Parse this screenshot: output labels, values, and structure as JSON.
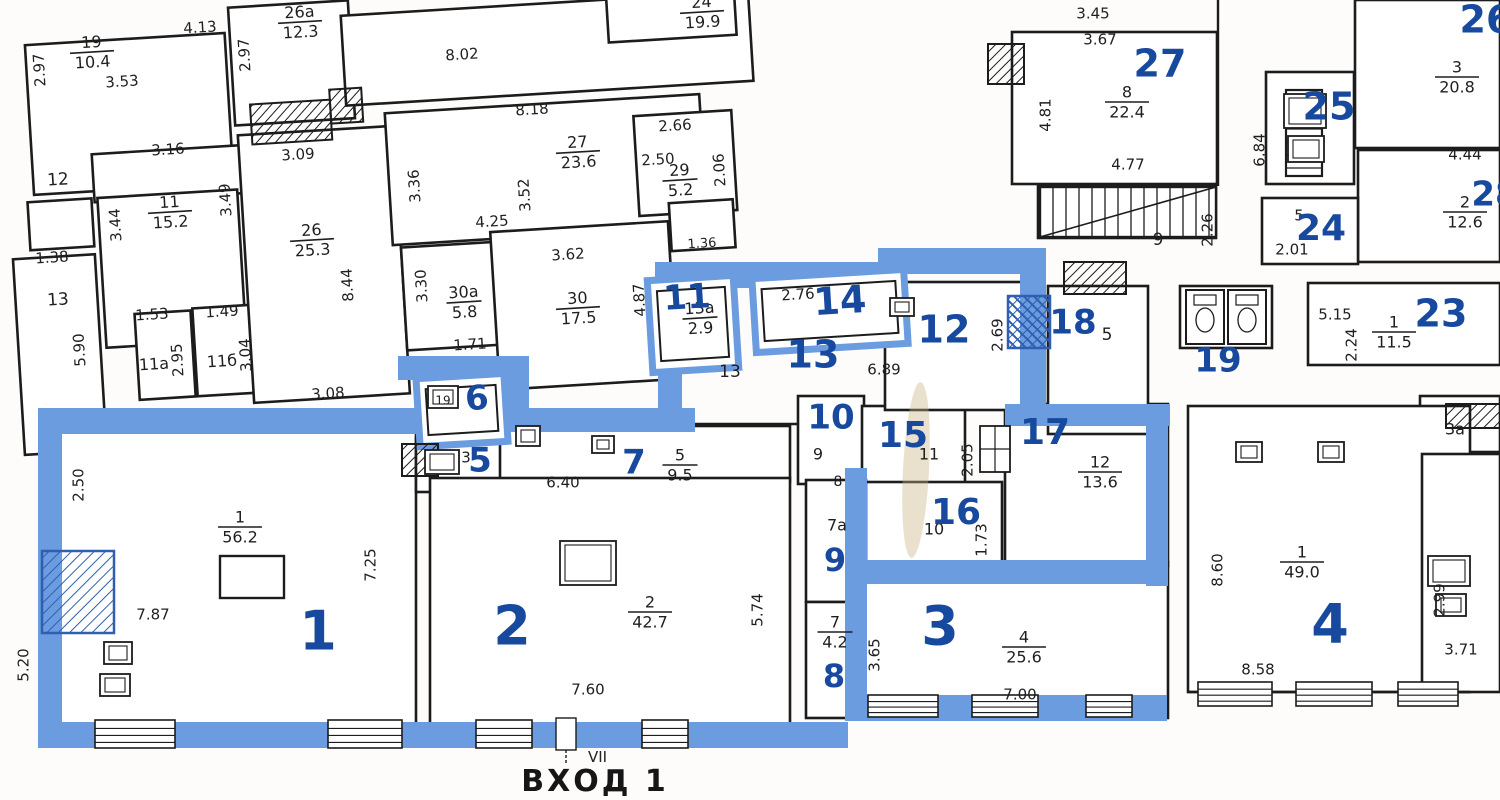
{
  "colors": {
    "highlight_band": "#6b9ce0",
    "highlight_band_dark": "#2e5fb0",
    "room_number_blue": "#17499e",
    "wall_black": "#1c1c1c",
    "paper": "#fdfcfa",
    "stain": "#c9b184"
  },
  "entrance": {
    "label": "ВХОД 1",
    "vestibule_mark": "VII"
  },
  "unit_room_numbers": [
    [
      "1",
      318,
      635,
      54,
      ""
    ],
    [
      "2",
      512,
      630,
      54,
      ""
    ],
    [
      "3",
      940,
      630,
      54,
      ""
    ],
    [
      "4",
      1330,
      628,
      54,
      ""
    ],
    [
      "5",
      480,
      462,
      34,
      ""
    ],
    [
      "6",
      477,
      400,
      34,
      "t"
    ],
    [
      "7",
      634,
      464,
      34,
      ""
    ],
    [
      "8",
      834,
      678,
      32,
      ""
    ],
    [
      "9",
      835,
      562,
      32,
      ""
    ],
    [
      "10",
      831,
      419,
      34,
      ""
    ],
    [
      "11",
      687,
      299,
      34,
      "t"
    ],
    [
      "12",
      944,
      332,
      38,
      ""
    ],
    [
      "13",
      813,
      357,
      38,
      ""
    ],
    [
      "14",
      840,
      303,
      38,
      "t"
    ],
    [
      "15",
      903,
      437,
      36,
      ""
    ],
    [
      "16",
      956,
      514,
      36,
      ""
    ],
    [
      "17",
      1045,
      434,
      36,
      ""
    ],
    [
      "18",
      1073,
      324,
      34,
      ""
    ],
    [
      "19",
      1218,
      362,
      34,
      ""
    ]
  ],
  "neighbor_room_numbers": [
    [
      "23",
      1441,
      316,
      38,
      ""
    ],
    [
      "24",
      1321,
      230,
      36,
      ""
    ],
    [
      "25",
      1329,
      109,
      38,
      ""
    ],
    [
      "26",
      1486,
      22,
      38,
      ""
    ],
    [
      "27",
      1160,
      66,
      38,
      ""
    ],
    [
      "28",
      1495,
      196,
      34,
      ""
    ]
  ],
  "room_area_labels": [
    [
      "19",
      "10.4",
      92,
      52,
      "t"
    ],
    [
      "26а",
      "12.3",
      300,
      22,
      "t"
    ],
    [
      "11",
      "15.2",
      170,
      212,
      "t"
    ],
    [
      "26",
      "25.3",
      312,
      240,
      "t"
    ],
    [
      "27",
      "23.6",
      578,
      152,
      "t"
    ],
    [
      "24",
      "19.9",
      702,
      12,
      "t"
    ],
    [
      "29",
      "5.2",
      680,
      180,
      "t"
    ],
    [
      "30а",
      "5.8",
      464,
      302,
      "t"
    ],
    [
      "30",
      "17.5",
      578,
      308,
      "t"
    ],
    [
      "13а",
      "2.9",
      700,
      318,
      "t"
    ],
    [
      "8",
      "22.4",
      1127,
      102,
      ""
    ],
    [
      "3",
      "20.8",
      1457,
      77,
      ""
    ],
    [
      "2",
      "12.6",
      1465,
      212,
      ""
    ],
    [
      "1",
      "11.5",
      1394,
      332,
      ""
    ],
    [
      "5",
      "9.5",
      680,
      465,
      ""
    ],
    [
      "12",
      "13.6",
      1100,
      472,
      ""
    ],
    [
      "4",
      "25.6",
      1024,
      647,
      ""
    ],
    [
      "2",
      "42.7",
      650,
      612,
      ""
    ],
    [
      "1",
      "56.2",
      240,
      527,
      ""
    ],
    [
      "1",
      "49.0",
      1302,
      562,
      ""
    ],
    [
      "7",
      "4.2",
      835,
      632,
      ""
    ]
  ],
  "dimension_labels": [
    [
      "2.97",
      40,
      70,
      "vt"
    ],
    [
      "3.53",
      122,
      82,
      "t"
    ],
    [
      "4.13",
      200,
      28,
      "t"
    ],
    [
      "2.97",
      245,
      55,
      "vt"
    ],
    [
      "3.16",
      168,
      150,
      "t"
    ],
    [
      "3.09",
      298,
      155,
      "t"
    ],
    [
      "12",
      58,
      180,
      "t",
      17
    ],
    [
      "3.44",
      116,
      225,
      "vt"
    ],
    [
      "3.49",
      226,
      200,
      "vt"
    ],
    [
      "1.38",
      52,
      258,
      "t"
    ],
    [
      "13",
      58,
      300,
      "t",
      17
    ],
    [
      "8.44",
      348,
      285,
      "vt"
    ],
    [
      "1.53",
      152,
      315,
      "t"
    ],
    [
      "1.49",
      222,
      312,
      "t"
    ],
    [
      "5.90",
      80,
      350,
      "vt"
    ],
    [
      "11а",
      154,
      365,
      "t",
      16
    ],
    [
      "2.95",
      178,
      360,
      "vt"
    ],
    [
      "11б",
      222,
      362,
      "t",
      16
    ],
    [
      "3.04",
      246,
      355,
      "vt"
    ],
    [
      "3.08",
      328,
      394,
      "t"
    ],
    [
      "8.02",
      462,
      55,
      "t"
    ],
    [
      "8.18",
      532,
      110,
      "t"
    ],
    [
      "3.36",
      415,
      186,
      "vt"
    ],
    [
      "3.52",
      525,
      195,
      "vt"
    ],
    [
      "4.25",
      492,
      222,
      "t"
    ],
    [
      "2.66",
      675,
      126,
      "t"
    ],
    [
      "2.50",
      658,
      160,
      "t"
    ],
    [
      "2.06",
      720,
      170,
      "vt"
    ],
    [
      "3.30",
      422,
      286,
      "vt"
    ],
    [
      "3.62",
      568,
      255,
      "t"
    ],
    [
      "4.87",
      640,
      300,
      "vt"
    ],
    [
      "1.71",
      470,
      345,
      "t"
    ],
    [
      "1.36",
      702,
      244,
      "t",
      13
    ],
    [
      "2.76",
      798,
      295,
      "t"
    ],
    [
      "13",
      730,
      372,
      "",
      17
    ],
    [
      "6.89",
      884,
      370,
      ""
    ],
    [
      "2.69",
      998,
      335,
      "v"
    ],
    [
      "5",
      1107,
      335,
      "",
      17
    ],
    [
      "3.45",
      1093,
      14,
      ""
    ],
    [
      "3.67",
      1100,
      40,
      ""
    ],
    [
      "4.81",
      1046,
      115,
      "v"
    ],
    [
      "4.77",
      1128,
      165,
      ""
    ],
    [
      "6.84",
      1260,
      150,
      "v"
    ],
    [
      "9",
      1158,
      240,
      "",
      17
    ],
    [
      "2.26",
      1208,
      230,
      "v"
    ],
    [
      "5",
      1299,
      216,
      "",
      15
    ],
    [
      "2.01",
      1292,
      250,
      ""
    ],
    [
      "4.44",
      1465,
      155,
      ""
    ],
    [
      "5.15",
      1335,
      315,
      ""
    ],
    [
      "2.24",
      1352,
      345,
      "v"
    ],
    [
      "3а",
      1455,
      430,
      "",
      16
    ],
    [
      "3",
      466,
      458,
      "",
      15
    ],
    [
      "19",
      443,
      401,
      "",
      12
    ],
    [
      "6.40",
      563,
      483,
      ""
    ],
    [
      "9",
      818,
      455,
      "",
      16
    ],
    [
      "8",
      838,
      482,
      "",
      14
    ],
    [
      "11",
      929,
      455,
      "",
      16
    ],
    [
      "2.05",
      968,
      460,
      "v"
    ],
    [
      "10",
      934,
      530,
      "",
      16
    ],
    [
      "1.73",
      982,
      540,
      "v"
    ],
    [
      "7а",
      837,
      526,
      "",
      16
    ],
    [
      "2.50",
      79,
      485,
      "v"
    ],
    [
      "7.25",
      371,
      565,
      "v"
    ],
    [
      "7.87",
      153,
      615,
      ""
    ],
    [
      "5.20",
      24,
      665,
      "v"
    ],
    [
      "7.60",
      588,
      690,
      ""
    ],
    [
      "5.74",
      758,
      610,
      "v"
    ],
    [
      "3.65",
      875,
      655,
      "v"
    ],
    [
      "7.00",
      1020,
      695,
      ""
    ],
    [
      "8.60",
      1218,
      570,
      "v"
    ],
    [
      "8.58",
      1258,
      670,
      ""
    ],
    [
      "2.99",
      1440,
      600,
      "v"
    ],
    [
      "3.71",
      1461,
      650,
      ""
    ]
  ]
}
